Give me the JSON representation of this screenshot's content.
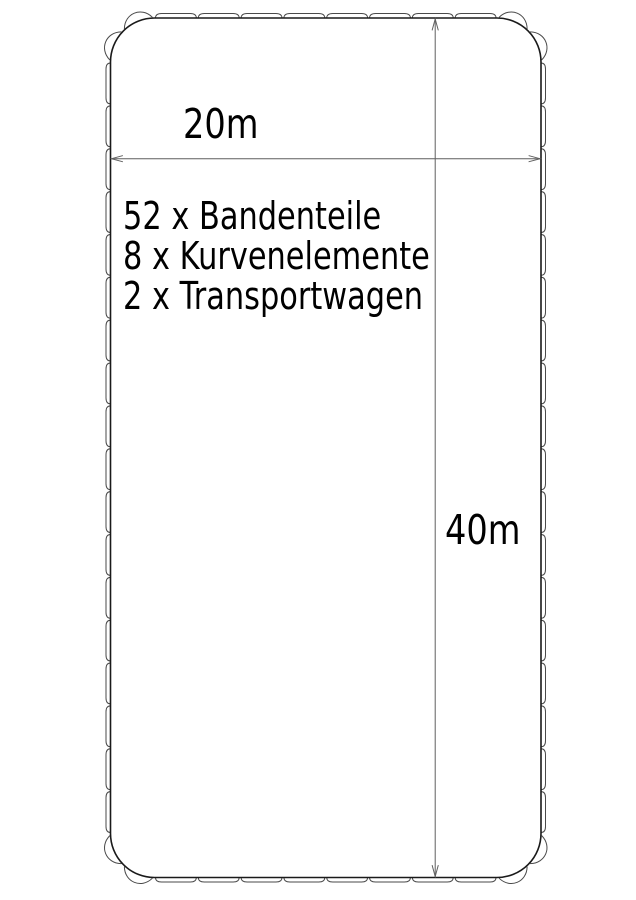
{
  "figure": {
    "background": "#ffffff",
    "dimension_labels": {
      "width": "20m",
      "height": "40m"
    },
    "parts_list": [
      "52 x Bandenteile",
      "8 x Kurvenelemente",
      "2 x Transportwagen"
    ],
    "rink": {
      "width_m": 20,
      "length_m": 40,
      "band_segments_total": 52,
      "curve_elements_total": 8,
      "transport_carts_total": 2,
      "straight_segments_short_side": 8,
      "straight_segments_long_side": 18,
      "curve_elements_per_corner": 2
    },
    "colors": {
      "inner_line": "#1a1a1a",
      "outer_line": "#4a4a4a",
      "dimension_line": "#5f5f5f",
      "text": "#000000"
    }
  }
}
